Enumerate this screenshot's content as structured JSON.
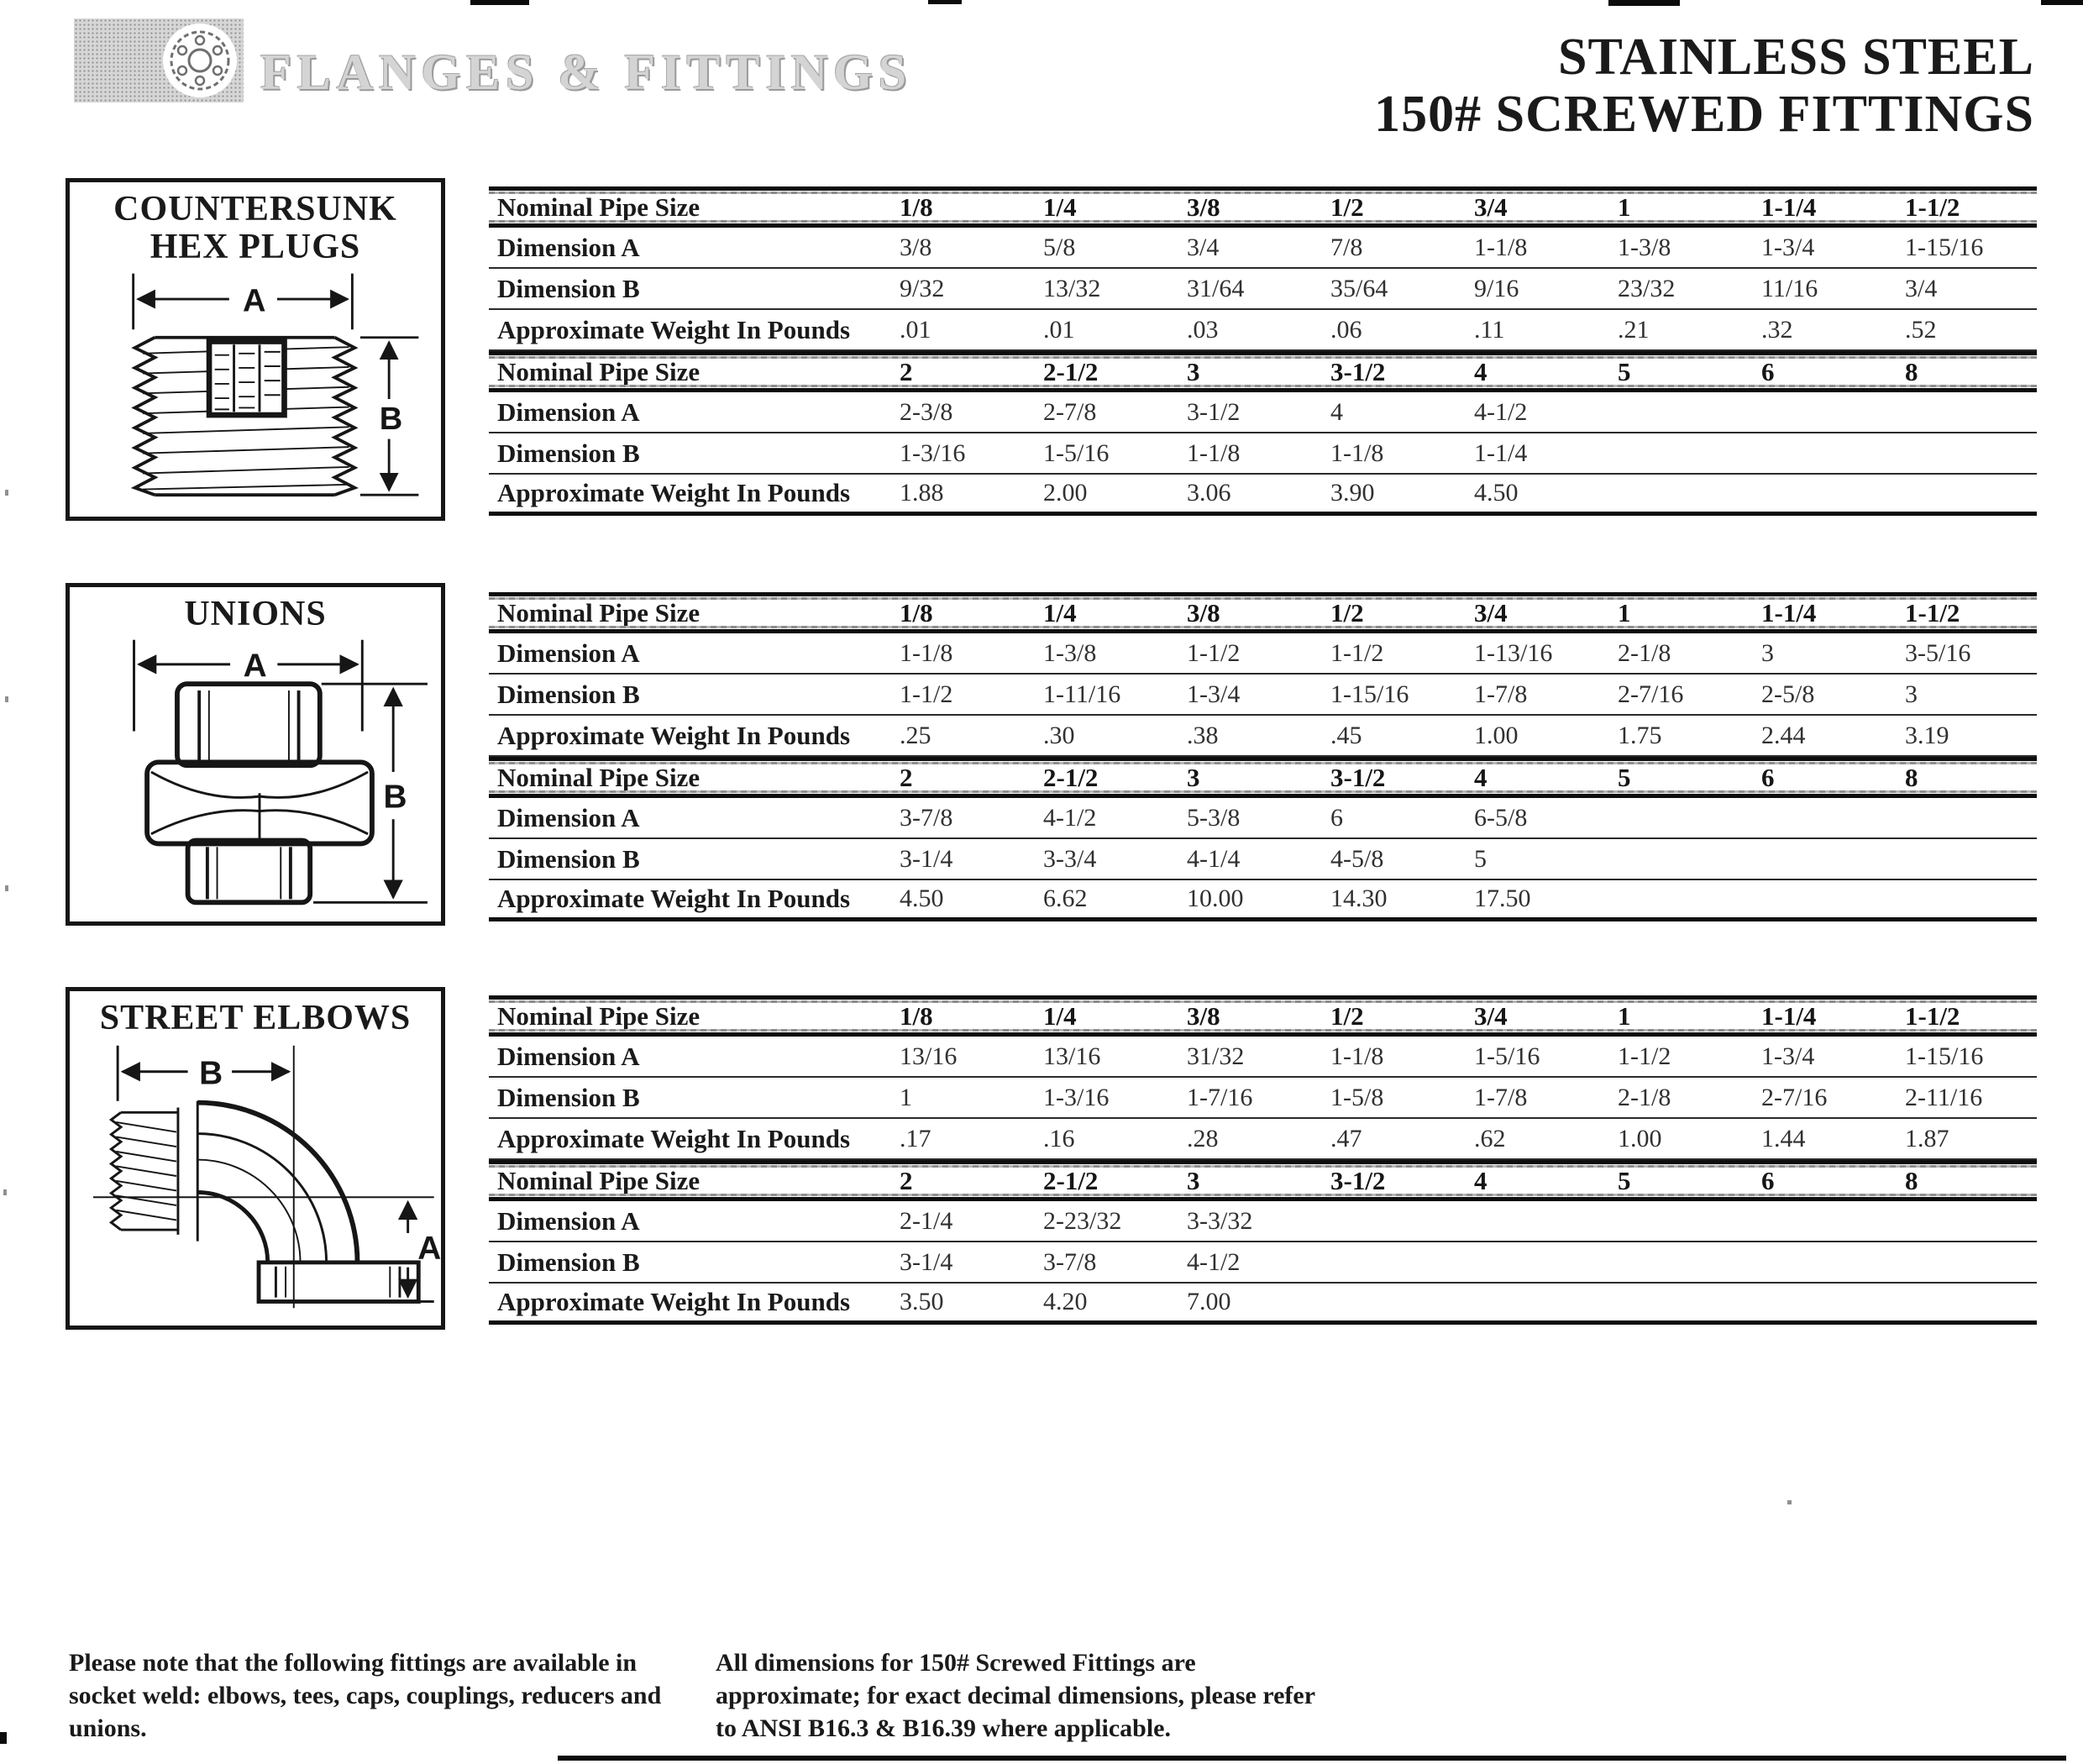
{
  "page": {
    "brand": "FLANGES & FITTINGS",
    "title_line1": "STAINLESS STEEL",
    "title_line2": "150# SCREWED FITTINGS"
  },
  "row_labels": {
    "size": "Nominal Pipe Size",
    "dim_a": "Dimension A",
    "dim_b": "Dimension B",
    "weight": "Approximate Weight In Pounds"
  },
  "sections": [
    {
      "name": "countersunk-hex-plugs",
      "box_title_line1": "COUNTERSUNK",
      "box_title_line2": "HEX PLUGS",
      "diagram": {
        "arrow_top": "A",
        "arrow_side": "B"
      },
      "table": {
        "half1": {
          "sizes": [
            "1/8",
            "1/4",
            "3/8",
            "1/2",
            "3/4",
            "1",
            "1-1/4",
            "1-1/2"
          ],
          "dim_a": [
            "3/8",
            "5/8",
            "3/4",
            "7/8",
            "1-1/8",
            "1-3/8",
            "1-3/4",
            "1-15/16"
          ],
          "dim_b": [
            "9/32",
            "13/32",
            "31/64",
            "35/64",
            "9/16",
            "23/32",
            "11/16",
            "3/4"
          ],
          "weight": [
            ".01",
            ".01",
            ".03",
            ".06",
            ".11",
            ".21",
            ".32",
            ".52"
          ]
        },
        "half2": {
          "sizes": [
            "2",
            "2-1/2",
            "3",
            "3-1/2",
            "4",
            "5",
            "6",
            "8"
          ],
          "dim_a": [
            "2-3/8",
            "2-7/8",
            "3-1/2",
            "4",
            "4-1/2",
            "",
            "",
            ""
          ],
          "dim_b": [
            "1-3/16",
            "1-5/16",
            "1-1/8",
            "1-1/8",
            "1-1/4",
            "",
            "",
            ""
          ],
          "weight": [
            "1.88",
            "2.00",
            "3.06",
            "3.90",
            "4.50",
            "",
            "",
            ""
          ]
        }
      }
    },
    {
      "name": "unions",
      "box_title_line1": "UNIONS",
      "box_title_line2": "",
      "diagram": {
        "arrow_top": "A",
        "arrow_side": "B"
      },
      "table": {
        "half1": {
          "sizes": [
            "1/8",
            "1/4",
            "3/8",
            "1/2",
            "3/4",
            "1",
            "1-1/4",
            "1-1/2"
          ],
          "dim_a": [
            "1-1/8",
            "1-3/8",
            "1-1/2",
            "1-1/2",
            "1-13/16",
            "2-1/8",
            "3",
            "3-5/16"
          ],
          "dim_b": [
            "1-1/2",
            "1-11/16",
            "1-3/4",
            "1-15/16",
            "1-7/8",
            "2-7/16",
            "2-5/8",
            "3"
          ],
          "weight": [
            ".25",
            ".30",
            ".38",
            ".45",
            "1.00",
            "1.75",
            "2.44",
            "3.19"
          ]
        },
        "half2": {
          "sizes": [
            "2",
            "2-1/2",
            "3",
            "3-1/2",
            "4",
            "5",
            "6",
            "8"
          ],
          "dim_a": [
            "3-7/8",
            "4-1/2",
            "5-3/8",
            "6",
            "6-5/8",
            "",
            "",
            ""
          ],
          "dim_b": [
            "3-1/4",
            "3-3/4",
            "4-1/4",
            "4-5/8",
            "5",
            "",
            "",
            ""
          ],
          "weight": [
            "4.50",
            "6.62",
            "10.00",
            "14.30",
            "17.50",
            "",
            "",
            ""
          ]
        }
      }
    },
    {
      "name": "street-elbows",
      "box_title_line1": "STREET ELBOWS",
      "box_title_line2": "",
      "diagram": {
        "arrow_top": "B",
        "arrow_side": "A"
      },
      "table": {
        "half1": {
          "sizes": [
            "1/8",
            "1/4",
            "3/8",
            "1/2",
            "3/4",
            "1",
            "1-1/4",
            "1-1/2"
          ],
          "dim_a": [
            "13/16",
            "13/16",
            "31/32",
            "1-1/8",
            "1-5/16",
            "1-1/2",
            "1-3/4",
            "1-15/16"
          ],
          "dim_b": [
            "1",
            "1-3/16",
            "1-7/16",
            "1-5/8",
            "1-7/8",
            "2-1/8",
            "2-7/16",
            "2-11/16"
          ],
          "weight": [
            ".17",
            ".16",
            ".28",
            ".47",
            ".62",
            "1.00",
            "1.44",
            "1.87"
          ]
        },
        "half2": {
          "sizes": [
            "2",
            "2-1/2",
            "3",
            "3-1/2",
            "4",
            "5",
            "6",
            "8"
          ],
          "dim_a": [
            "2-1/4",
            "2-23/32",
            "3-3/32",
            "",
            "",
            "",
            "",
            ""
          ],
          "dim_b": [
            "3-1/4",
            "3-7/8",
            "4-1/2",
            "",
            "",
            "",
            "",
            ""
          ],
          "weight": [
            "3.50",
            "4.20",
            "7.00",
            "",
            "",
            "",
            "",
            ""
          ]
        }
      }
    }
  ],
  "footnotes": {
    "left": "Please note that the following fittings are available in socket weld: elbows, tees, caps, couplings, reducers and unions.",
    "right": "All dimensions for 150# Screwed Fittings are approximate; for exact decimal dimensions, please refer to ANSI B16.3 & B16.39 where applicable."
  }
}
